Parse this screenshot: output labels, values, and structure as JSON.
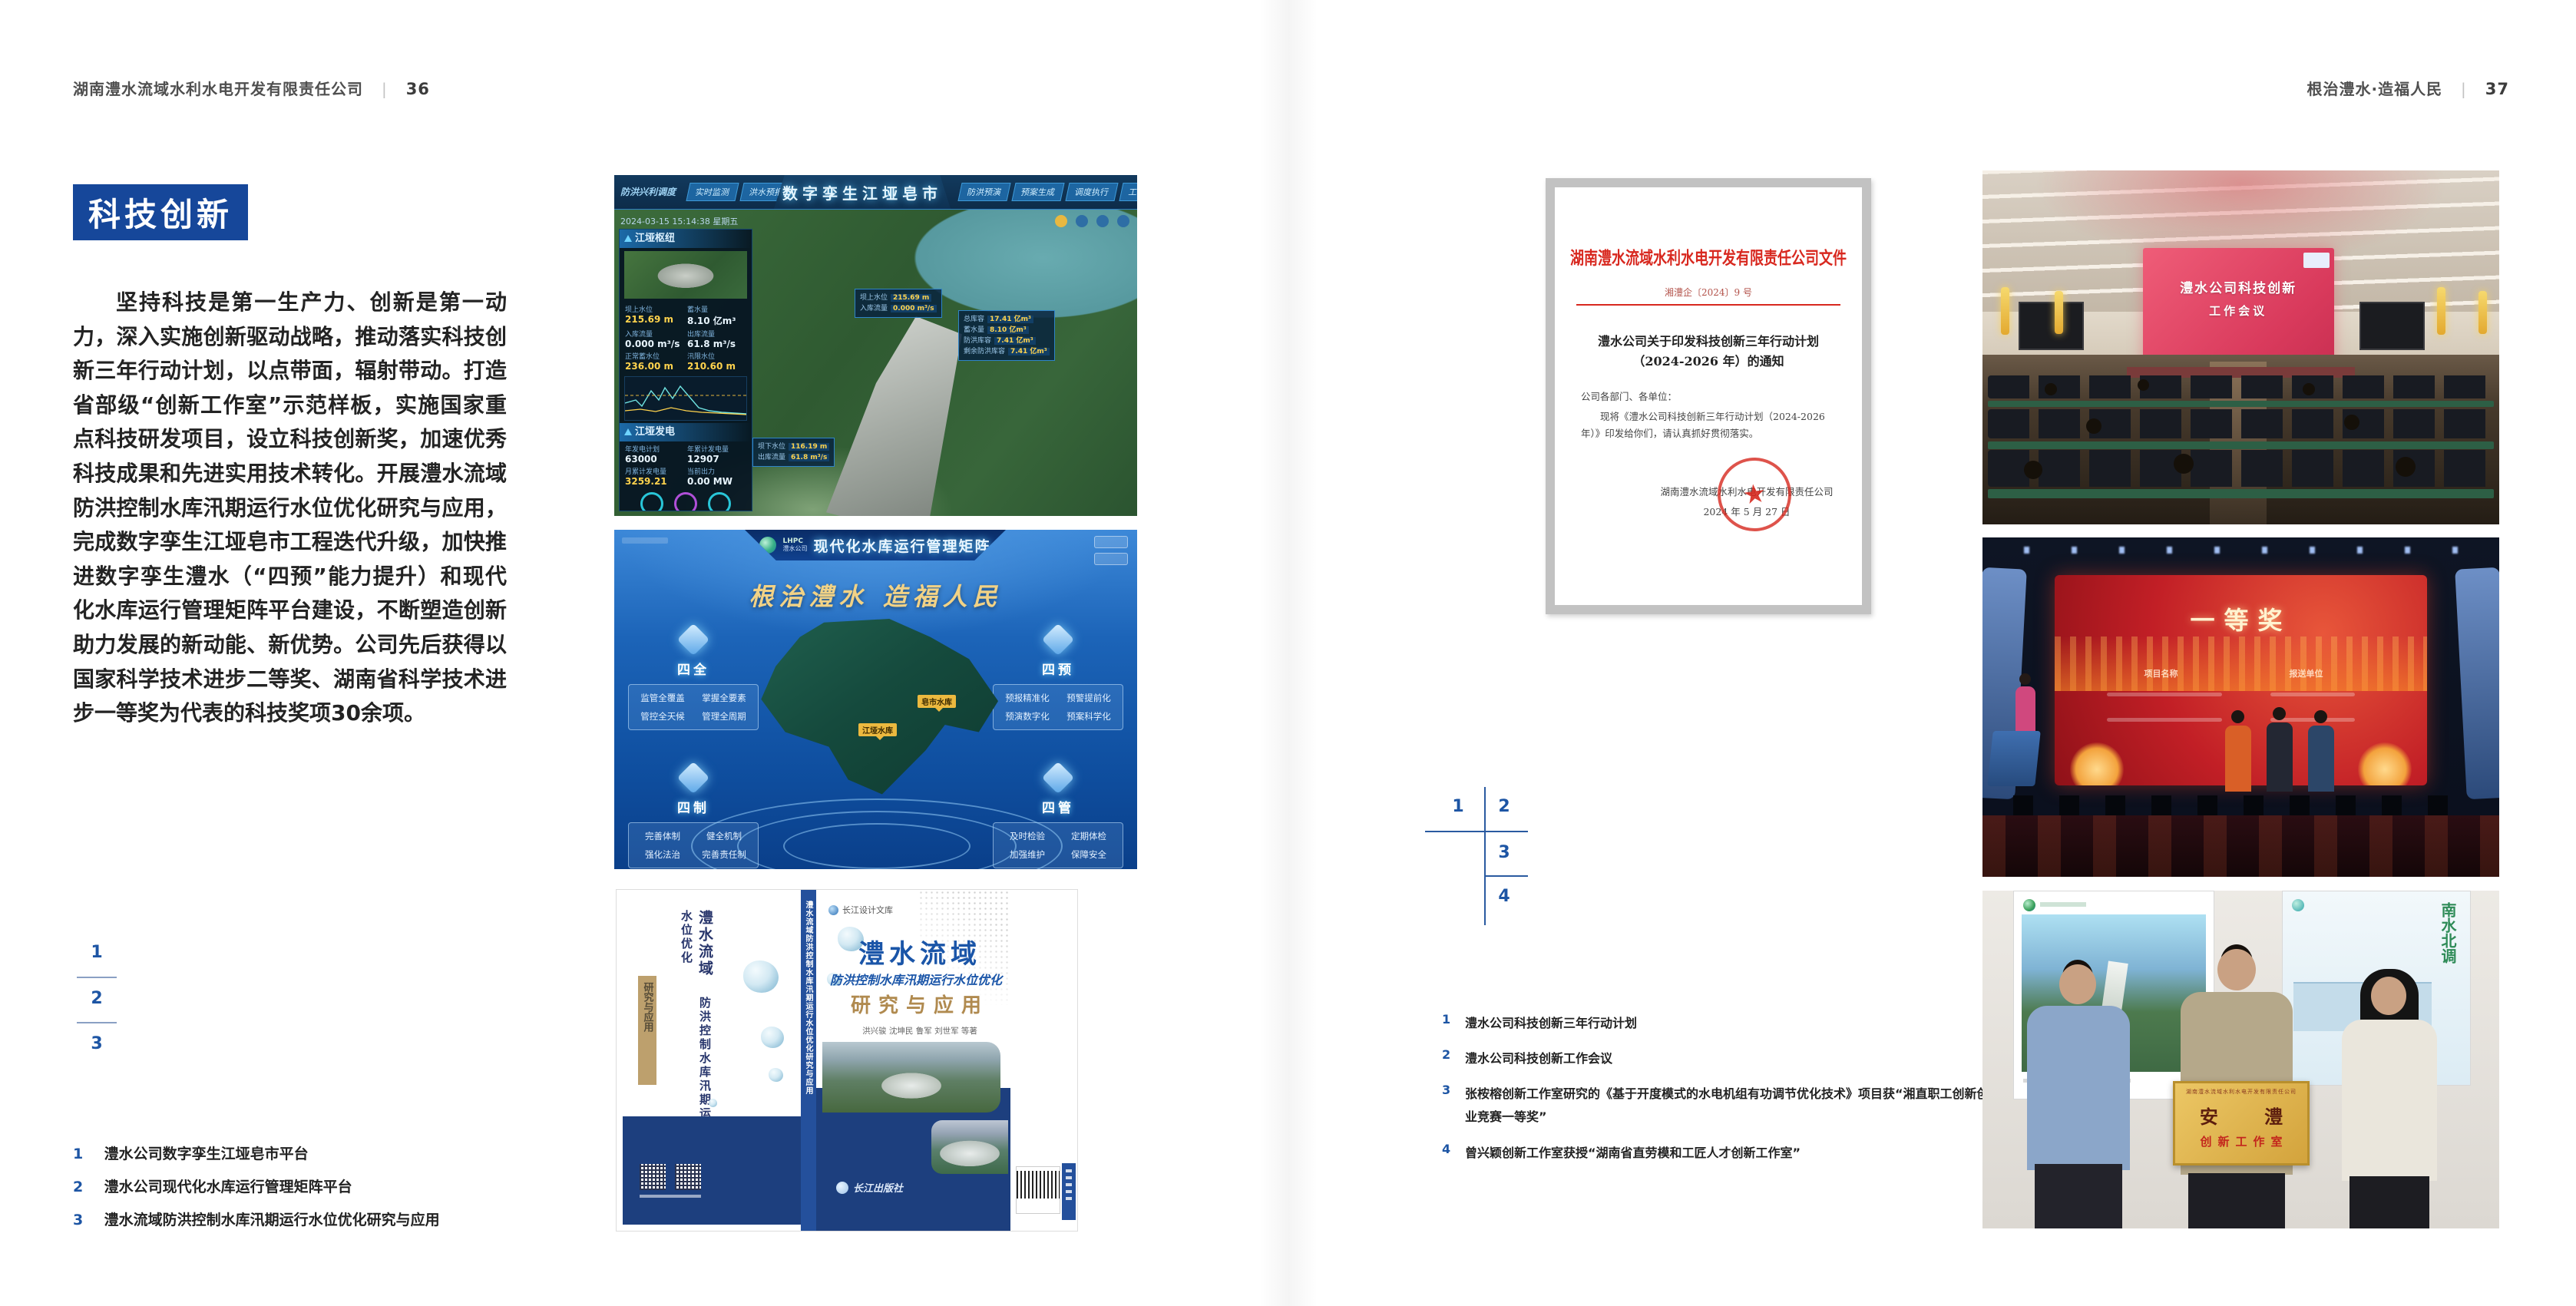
{
  "left": {
    "header": {
      "company": "湖南澧水流域水利水电开发有限责任公司",
      "divider": "|",
      "page": "36"
    },
    "section_title": "科技创新",
    "paragraph": "坚持科技是第一生产力、创新是第一动力，深入实施创新驱动战略，推动落实科技创新三年行动计划，以点带面，辐射带动。打造省部级“创新工作室”示范样板，实施国家重点科技研发项目，设立科技创新奖，加速优秀科技成果和先进实用技术转化。开展澧水流域防洪控制水库汛期运行水位优化研究与应用，完成数字孪生江垭皂市工程迭代升级，加快推进数字孪生澧水（“四预”能力提升）和现代化水库运行管理矩阵平台建设，不断塑造创新助力发展的新动能、新优势。公司先后获得以国家科学技术进步二等奖、湖南省科学技术进步一等奖为代表的科技奖项30余项。",
    "fig": {
      "n1": "1",
      "n2": "2",
      "n3": "3"
    },
    "captions": [
      {
        "n": "1",
        "t": "澧水公司数字孪生江垭皂市平台"
      },
      {
        "n": "2",
        "t": "澧水公司现代化水库运行管理矩阵平台"
      },
      {
        "n": "3",
        "t": "澧水流域防洪控制水库汛期运行水位优化研究与应用"
      }
    ]
  },
  "right": {
    "header": {
      "title": "根治澧水·造福人民",
      "divider": "|",
      "page": "37"
    },
    "fig": {
      "n1": "1",
      "n2": "2",
      "n3": "3",
      "n4": "4"
    },
    "captions": [
      {
        "n": "1",
        "t": "澧水公司科技创新三年行动计划"
      },
      {
        "n": "2",
        "t": "澧水公司科技创新工作会议"
      },
      {
        "n": "3",
        "t": "张桉榕创新工作室研究的《基于开度模式的水电机组有功调节优化技术》项目获“湘直职工创新创业竞赛一等奖”"
      },
      {
        "n": "4",
        "t": "曾兴颖创新工作室获授“湖南省直劳模和工匠人才创新工作室”"
      }
    ]
  },
  "dashboard": {
    "corner_label": "防洪兴利调度",
    "title": "数字孪生江垭皂市",
    "tabs_left": [
      "实时监测",
      "洪水预报",
      "防洪预警"
    ],
    "tabs_right": [
      "防洪预演",
      "预案生成",
      "调度执行",
      "工程巡视"
    ],
    "timestamp": "2024-03-15 15:14:38 星期五",
    "panel1": {
      "title": "江垭枢纽",
      "stats": [
        {
          "l": "坝上水位",
          "v": "215.69 m"
        },
        {
          "l": "蓄水量",
          "v": "8.10 亿m³"
        },
        {
          "l": "入库流量",
          "v": "0.000 m³/s"
        },
        {
          "l": "出库流量",
          "v": "61.8 m³/s"
        },
        {
          "l": "正常蓄水位",
          "v": "236.00 m"
        },
        {
          "l": "汛限水位",
          "v": "210.60 m"
        }
      ]
    },
    "panel2": {
      "title": "江垭发电",
      "stats": [
        {
          "l": "年发电计划",
          "v": "63000"
        },
        {
          "l": "年累计发电量",
          "v": "12907"
        },
        {
          "l": "月累计发电量",
          "v": "3259.21"
        },
        {
          "l": "当前出力",
          "v": "0.00 MW"
        }
      ]
    },
    "popup1": [
      {
        "l": "坝上水位",
        "v": "215.69 m"
      },
      {
        "l": "入库流量",
        "v": "0.000 m³/s"
      }
    ],
    "popup2": [
      {
        "l": "总库容",
        "v": "17.41 亿m³"
      },
      {
        "l": "蓄水量",
        "v": "8.10 亿m³"
      },
      {
        "l": "防洪库容",
        "v": "7.41 亿m³"
      },
      {
        "l": "剩余防洪库容",
        "v": "7.41 亿m³"
      }
    ],
    "popup3": [
      {
        "l": "坝下水位",
        "v": "116.19 m"
      },
      {
        "l": "出库流量",
        "v": "61.8 m³/s"
      }
    ]
  },
  "platform": {
    "brand_abbr": "LHPC",
    "brand": "澧水公司",
    "title": "现代化水库运行管理矩阵",
    "slogan": "根治澧水 造福人民",
    "quadrants": [
      {
        "name": "四全",
        "items": [
          "监管全覆盖",
          "掌握全要素",
          "管控全天候",
          "管理全周期"
        ]
      },
      {
        "name": "四预",
        "items": [
          "预报精准化",
          "预警提前化",
          "预演数字化",
          "预案科学化"
        ]
      },
      {
        "name": "四制",
        "items": [
          "完善体制",
          "健全机制",
          "强化法治",
          "完善责任制"
        ]
      },
      {
        "name": "四管",
        "items": [
          "及时检验",
          "定期体检",
          "加强维护",
          "保障安全"
        ]
      }
    ],
    "map_labels": [
      "皂市水库",
      "江垭水库"
    ]
  },
  "book": {
    "series": "长江设计文库",
    "title_main": "澧水流域",
    "title_sub": "防洪控制水库汛期运行水位优化",
    "title_tail": "研究与应用",
    "authors": "洪兴骏 沈坤民 鲁军 刘世军 等著",
    "publisher": "长江出版社",
    "spine": "澧水流域防洪控制水库汛期运行水位优化研究与应用"
  },
  "document": {
    "headline": "湖南澧水流域水利水电开发有限责任公司文件",
    "doc_no": "湘澧企〔2024〕9 号",
    "subject1": "澧水公司关于印发科技创新三年行动计划",
    "subject2": "（2024-2026 年）的通知",
    "salutation": "公司各部门、各单位：",
    "body": "现将《澧水公司科技创新三年行动计划（2024-2026 年）》印发给你们，请认真抓好贯彻落实。",
    "signer": "湖南澧水流域水利水电开发有限责任公司",
    "date": "2024 年 5 月 27 日",
    "seal_star": "★"
  },
  "meeting": {
    "screen1": "澧水公司科技创新",
    "screen2": "工作会议"
  },
  "award": {
    "title": "一等奖",
    "col1": "项目名称",
    "col2": "报送单位"
  },
  "group": {
    "plaque_header": "湖南澧水流域水利水电开发有限责任公司",
    "plaque_main": "安 澧",
    "plaque_sub": "创新工作室",
    "poster_text": "南水北调"
  }
}
